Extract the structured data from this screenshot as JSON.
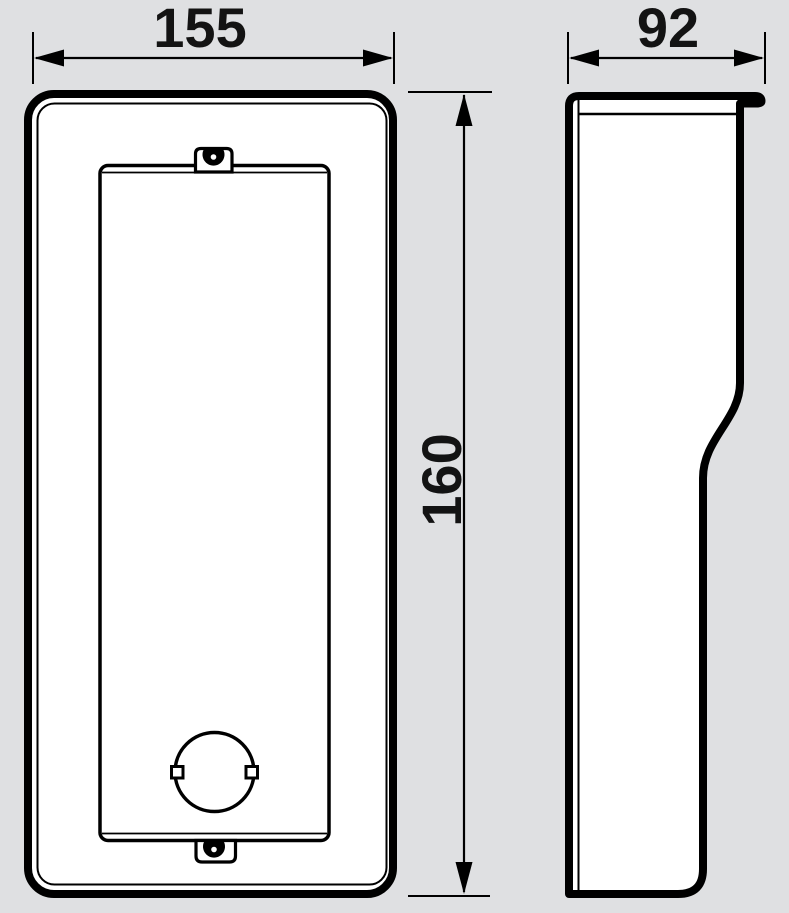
{
  "colors": {
    "background": "#dfe0e2",
    "ink": "#000000",
    "surface": "#ffffff"
  },
  "dimensions": {
    "width": {
      "label": "155"
    },
    "depth": {
      "label": "92"
    },
    "height": {
      "label": "160"
    }
  }
}
